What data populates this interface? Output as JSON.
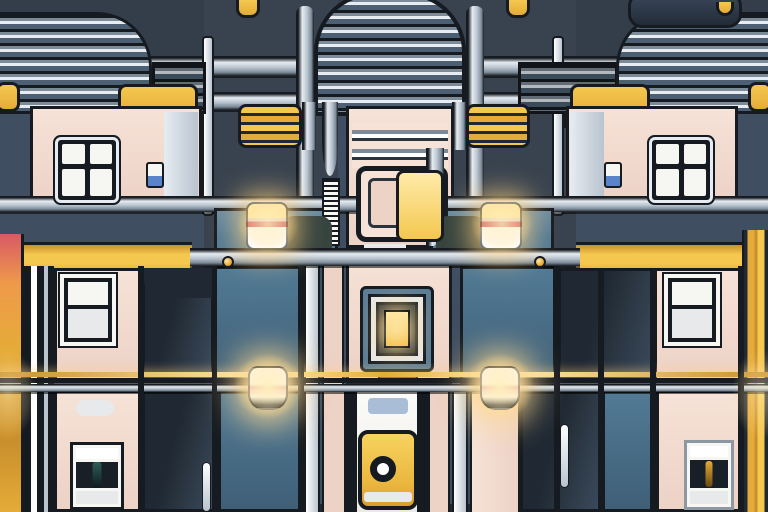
{
  "meta": {
    "type": "illustration",
    "alt": "Symmetrical stylized illustration of a futuristic building facade at dusk: louvered metal tower tops, pink walls with black-framed paned windows, yellow awnings and striped vents, chrome rails, a central white door with a yellow round-knob sign, and glowing lamps on a ledge and a wire"
  },
  "palette": {
    "outline": "#161b21",
    "bgSlate": "#3f4e61",
    "bgDark": "#39434f",
    "bgTop": "#333e4a",
    "navy": "#29343f",
    "navyDeep": "#1f2833",
    "teal": "#527a95",
    "tealDark": "#3f5f77",
    "pink": "#edd2c6",
    "pinkLight": "#f6e2d7",
    "pinkDeep": "#d9b6a8",
    "white": "#f6f6f3",
    "offWhite": "#e7e9ea",
    "chromeLight": "#e6ecf2",
    "chrome": "#b9c4cf",
    "chromeDark": "#7d8b99",
    "slatDark": "#4d6073",
    "yellow": "#f4c84f",
    "gold": "#e5ab38",
    "goldDeep": "#c98f2c",
    "red": "#d85a64",
    "orange": "#ef9a4a",
    "glow": "#ffeaa9",
    "brown": "#8a5733",
    "chipBlue": "#5b83c9",
    "tagBlue": "#a9bdd6",
    "hoodGreen": "#37443f",
    "paneDark": "#191f26"
  },
  "scene": {
    "regions": [
      "left-louver-tower",
      "center-louver-tower",
      "right-louver-tower",
      "left-facade",
      "right-facade",
      "center-tower",
      "yellow-awnings",
      "yellow-striped-vents",
      "yellow-fascia-bands",
      "chrome-rails",
      "ledge",
      "teal-windows",
      "cube-lamps-on-ledge",
      "hanging-wire-lamps",
      "mid-pink-walls",
      "nested-center-window",
      "bottom-door",
      "door-knob-sign",
      "small-bottom-windows",
      "left-color-pipes",
      "right-gold-pipes"
    ],
    "ledge_lamp_count": 2,
    "wire_lamp_count": 2,
    "window_grid": "2x2"
  }
}
